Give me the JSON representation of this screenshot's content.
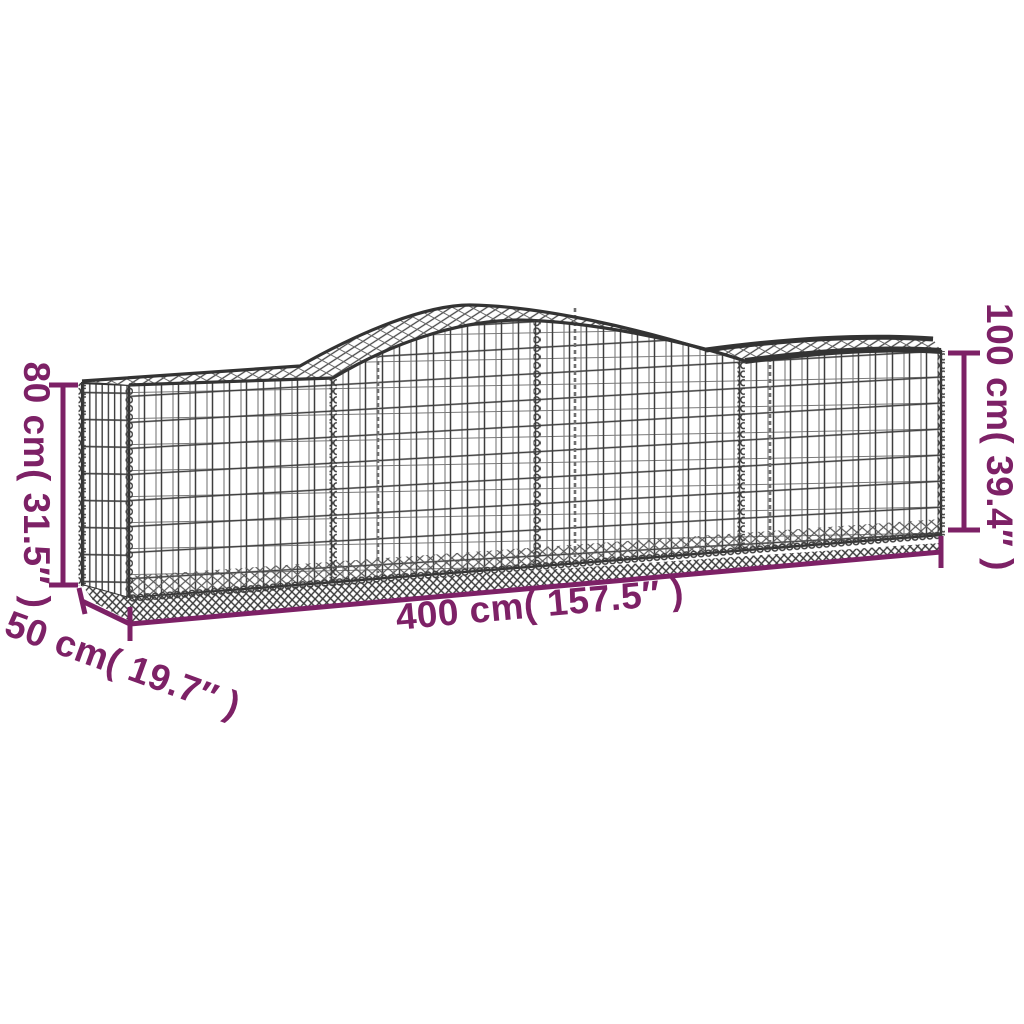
{
  "diagram": {
    "subject_label": "gabion-basket-dimension-diagram",
    "dimensions": {
      "height_left_label": "80 cm( 31.5″ )",
      "height_right_label": "100 cm( 39.4″ )",
      "length_label": "400 cm( 157.5″ )",
      "depth_label": "50 cm( 19.7″ )"
    },
    "colors": {
      "dimension_annotation": "#7D2166",
      "wire": "#3C3C3C",
      "background": "#FFFFFF"
    }
  }
}
